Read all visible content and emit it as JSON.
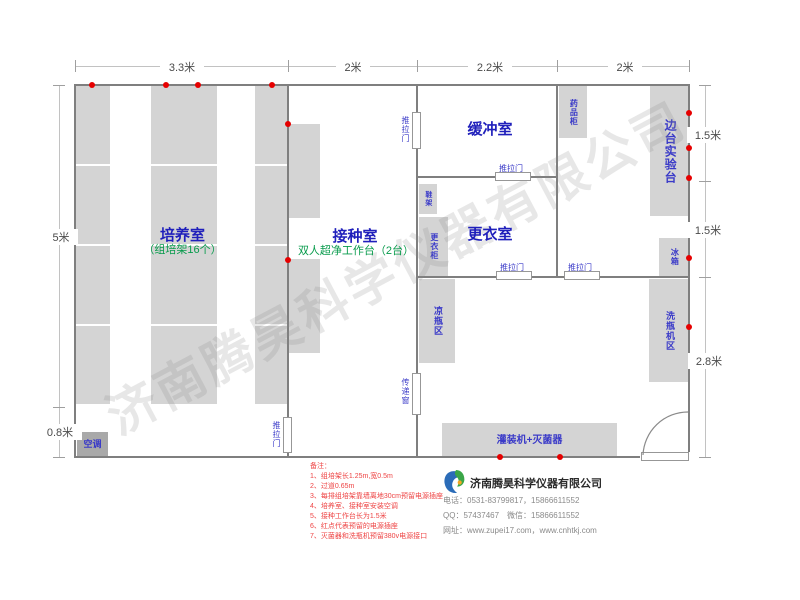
{
  "watermark": "济南腾昊科学仪器有限公司",
  "dimensions": {
    "top": [
      "3.3米",
      "2米",
      "2.2米",
      "2米"
    ],
    "left": [
      "5米",
      "0.8米"
    ],
    "right": [
      "1.5米",
      "1.5米",
      "2.8米"
    ]
  },
  "rooms": {
    "cultivation": {
      "name": "培养室",
      "sub": "（组培架16个）"
    },
    "inoculation": {
      "name": "接种室",
      "sub": "双人超净工作台（2台）"
    },
    "buffer": {
      "name": "缓冲室"
    },
    "changing": {
      "name": "更衣室"
    }
  },
  "furniture": {
    "ac": "空调",
    "medicine_cabinet": "药品柜",
    "side_bench": "边台实验台",
    "fridge": "冰箱",
    "bottle_washer_area": "洗瓶机区",
    "bottle_cooling_area": "凉瓶区",
    "shoe_rack": "鞋架",
    "wardrobe": "更衣柜",
    "filling_machine": "灌装机+灭菌器",
    "sliding_door": "推拉门",
    "pass_window": "传递窗"
  },
  "notes": {
    "title": "备注：",
    "items": [
      "1、组培架长1.25m,宽0.5m",
      "2、过道0.65m",
      "3、每排组培架靠墙离地30cm预留电源插座",
      "4、培养室、接种室安装空调",
      "5、接种工作台长为1.5米",
      "6、红点代表预留的电源插座",
      "7、灭菌器和洗瓶机预留380v电源接口"
    ]
  },
  "company": {
    "name": "济南腾昊科学仪器有限公司",
    "phone": "电话：0531-83799817，15866611552",
    "qq": "QQ：57437467　微信：15866611552",
    "web": "网址：www.zupei17.com，www.cnhtkj.com"
  },
  "colors": {
    "room_label": "#1f1fbb",
    "sub_label_green": "#089b4c",
    "furniture_fill": "#d4d4d4",
    "wall_gray": "#7f7f7f",
    "outlet_red": "#e60000",
    "note_red": "#ee4444",
    "logo_blue": "#2b6cb8",
    "logo_green": "#3aa648"
  }
}
